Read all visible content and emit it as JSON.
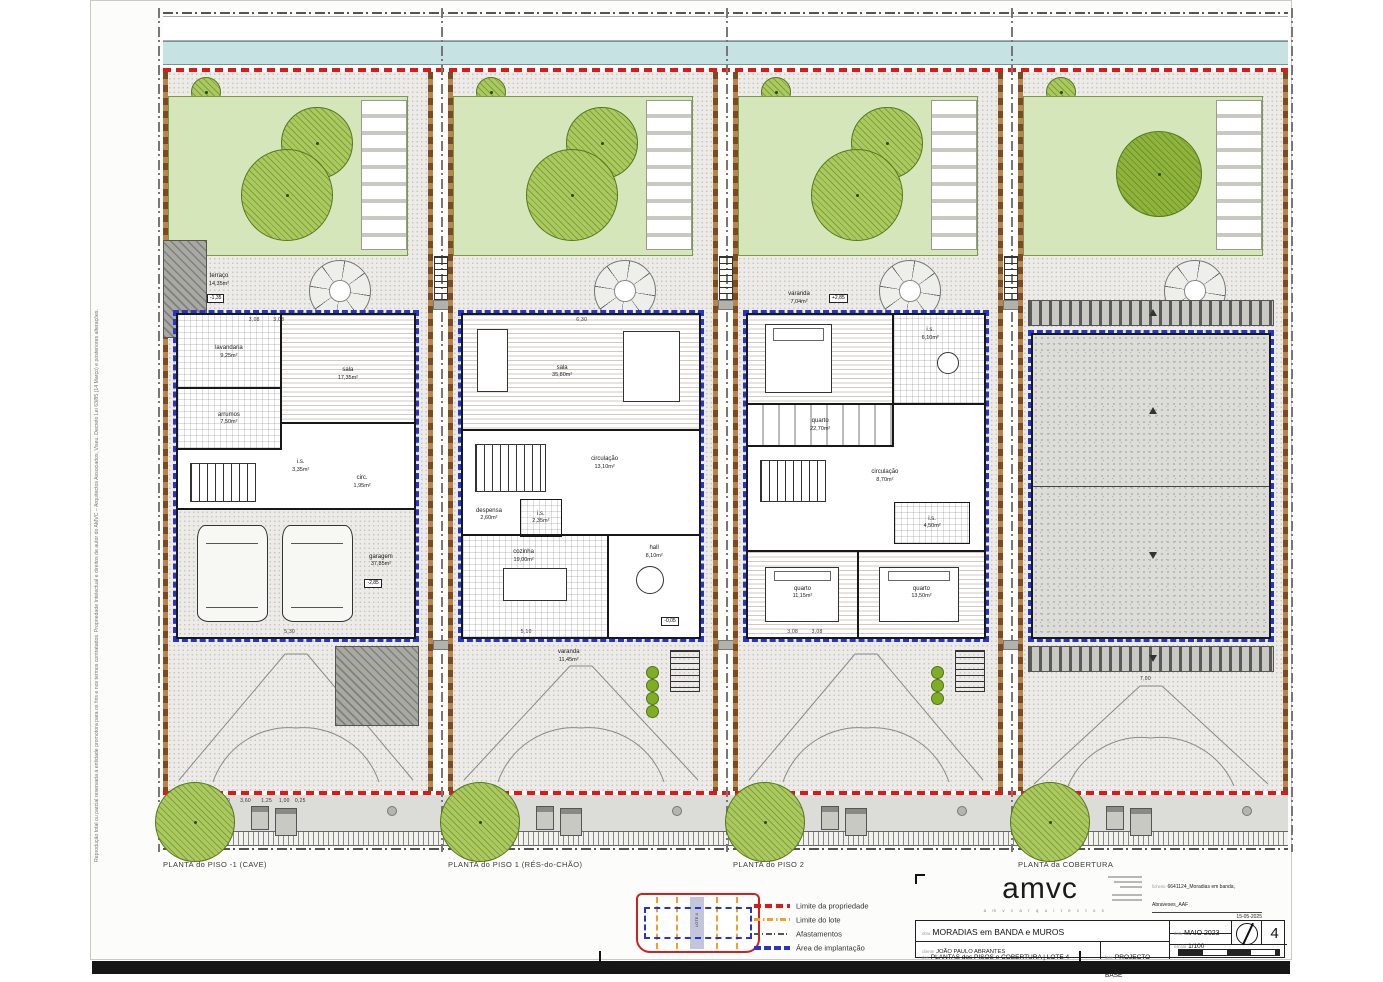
{
  "copyright": "Reprodução total ou parcial reservada à entidade promotora para os fins e nos termos contratados. Propriedade Intelectual e direitos de autor do AMVC – Arquitectos Associados, Viseu.          Decreto Lei 63/85 (14 Março) e posteriores alterações.",
  "panels": [
    {
      "caption": "PLANTA do PISO -1 (CAVE)",
      "outdoor": {
        "terrace_name": "terraço",
        "terrace_area": "14,35m²",
        "terrace_level": "-1,35"
      },
      "rooms": [
        {
          "name": "lavandaria",
          "area": "9,25m²"
        },
        {
          "name": "sala",
          "area": "17,35m²"
        },
        {
          "name": "arrumos",
          "area": "7,50m²"
        },
        {
          "name": "i.s.",
          "area": "3,35m²"
        },
        {
          "name": "circ.",
          "area": "1,95m²"
        },
        {
          "name": "garagem",
          "area": "37,85m²",
          "level": "-2,85"
        }
      ],
      "dims": {
        "top": "3,08        3,08",
        "garage": "5,30",
        "sidewalk": "5,00      3,60      1,25    1,00   0,25"
      }
    },
    {
      "caption": "PLANTA do PISO 1 (RÉS-do-CHÃO)",
      "outdoor": {
        "varanda_name": "varanda",
        "varanda_area": "11,45m²"
      },
      "rooms": [
        {
          "name": "sala",
          "area": "35,80m²"
        },
        {
          "name": "circulação",
          "area": "13,10m²"
        },
        {
          "name": "despensa",
          "area": "2,60m²"
        },
        {
          "name": "i.s.",
          "area": "2,35m²"
        },
        {
          "name": "cozinha",
          "area": "19,00m²"
        },
        {
          "name": "hall",
          "area": "8,10m²",
          "level": "-0,05"
        }
      ],
      "dims": {
        "top": "6,30",
        "bottom": "5,10"
      }
    },
    {
      "caption": "PLANTA do PISO 2",
      "outdoor": {
        "varanda_name": "varanda",
        "varanda_area": "7,04m²",
        "varanda_level": "+2,85"
      },
      "rooms": [
        {
          "name": "quarto",
          "area": "22,70m²"
        },
        {
          "name": "i.s.",
          "area": "6,10m²"
        },
        {
          "name": "circulação",
          "area": "8,70m²"
        },
        {
          "name": "i.s.",
          "area": "4,50m²"
        },
        {
          "name": "quarto",
          "area": "11,15m²"
        },
        {
          "name": "quarto",
          "area": "13,50m²"
        }
      ],
      "dims": {
        "bottom": "3,08        3,08"
      }
    },
    {
      "caption": "PLANTA da COBERTURA",
      "dims": {
        "left": "15,05",
        "bottom": "7,00"
      }
    }
  ],
  "legend": {
    "entries": [
      {
        "label": "Limite da propriedade"
      },
      {
        "label": "Limite do lote"
      },
      {
        "label": "Afastamentos"
      },
      {
        "label": "Área de implantação"
      }
    ],
    "colors": {
      "propriedade": "#e01818",
      "lote": "#f0a030",
      "afastamentos": "#555555",
      "implantacao": "#2535cc"
    },
    "keyplan_lot": "LOTE 4"
  },
  "titleblock": {
    "logo": "amvc",
    "logo_sub": "a m v c   a r q u i t e c t o s",
    "meta": {
      "ficheiro_label": "ficheiro",
      "ficheiro": "6641124_Moradias em banda, Abraveses_AAF",
      "desenhou_label": "desenhou",
      "desenhou": "VC",
      "desenhou_data": "15-05-2025",
      "verificou_label": "verificou",
      "verificou": "BM",
      "verificou_data": "15-05-2025",
      "autor_label": "autor",
      "autor": "Arquitecto Vitor Santos Cruz"
    },
    "fields": {
      "obra_label": "obra",
      "obra": "MORADIAS em BANDA e MUROS",
      "cliente_label": "cliente",
      "cliente": "JOÃO PAULO ABRANTES",
      "local_label": "local",
      "local": "TRAVESSA das CAMÉLIAS, ABRAVESES - VISEU",
      "des_label": "des",
      "des": "PLANTAS dos PISOS e COBERTURA  |  LOTE 4",
      "fase_label": "fase",
      "fase": "PROJECTO BASE",
      "data_label": "data",
      "data": "MAIO 2023",
      "escala_label": "escala",
      "escala": "1/100",
      "folha": "4"
    }
  },
  "palette": {
    "canal": "#c6e2e3",
    "lawn": "#d5e7ba",
    "tree": "#abc95e",
    "red": "#e01818",
    "orange": "#f0a030",
    "blue": "#2535cc",
    "wall_brown": "#7a4a20",
    "roof_gray": "#dcdcd8"
  }
}
